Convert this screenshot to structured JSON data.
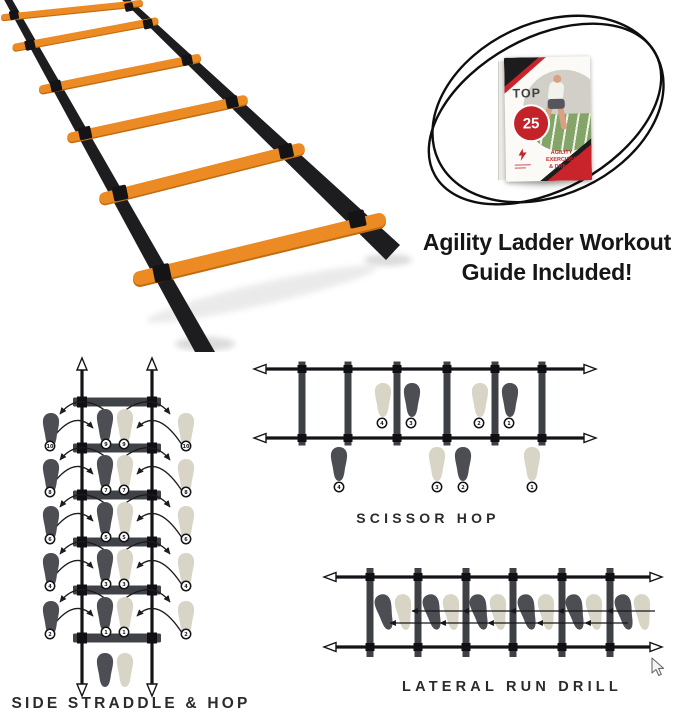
{
  "colors": {
    "ladder_orange": "#ec8a24",
    "strap_black": "#1d1d20",
    "rung_gray": "#3f4347",
    "foot_dark": "#4c4e53",
    "foot_light": "#d8d4c6",
    "accent_red": "#c9242b",
    "text_dark": "#161616"
  },
  "guide_callout": {
    "booklet": {
      "top_label": "TOP",
      "number": "25",
      "subtitle_line1": "AGILITY EXERCISES",
      "subtitle_line2": "& DRILLS"
    },
    "caption_line1": "Agility Ladder Workout",
    "caption_line2": "Guide Included!"
  },
  "diagrams": {
    "side_straddle": {
      "title": "SIDE STRADDLE & HOP",
      "rows": [
        {
          "outside_left": "10",
          "inside_left": "9",
          "inside_right": "9",
          "outside_right": "10"
        },
        {
          "outside_left": "8",
          "inside_left": "7",
          "inside_right": "7",
          "outside_right": "8"
        },
        {
          "outside_left": "6",
          "inside_left": "5",
          "inside_right": "5",
          "outside_right": "6"
        },
        {
          "outside_left": "4",
          "inside_left": "3",
          "inside_right": "3",
          "outside_right": "4"
        },
        {
          "outside_left": "2",
          "inside_left": "1",
          "inside_right": "1",
          "outside_right": "2"
        }
      ]
    },
    "scissor_hop": {
      "title": "SCISSOR HOP",
      "inside_steps": [
        "4",
        "3",
        "2",
        "1"
      ],
      "outside_steps": [
        "4",
        "3",
        "2",
        "1"
      ]
    },
    "lateral_run": {
      "title": "LATERAL RUN DRILL"
    }
  }
}
